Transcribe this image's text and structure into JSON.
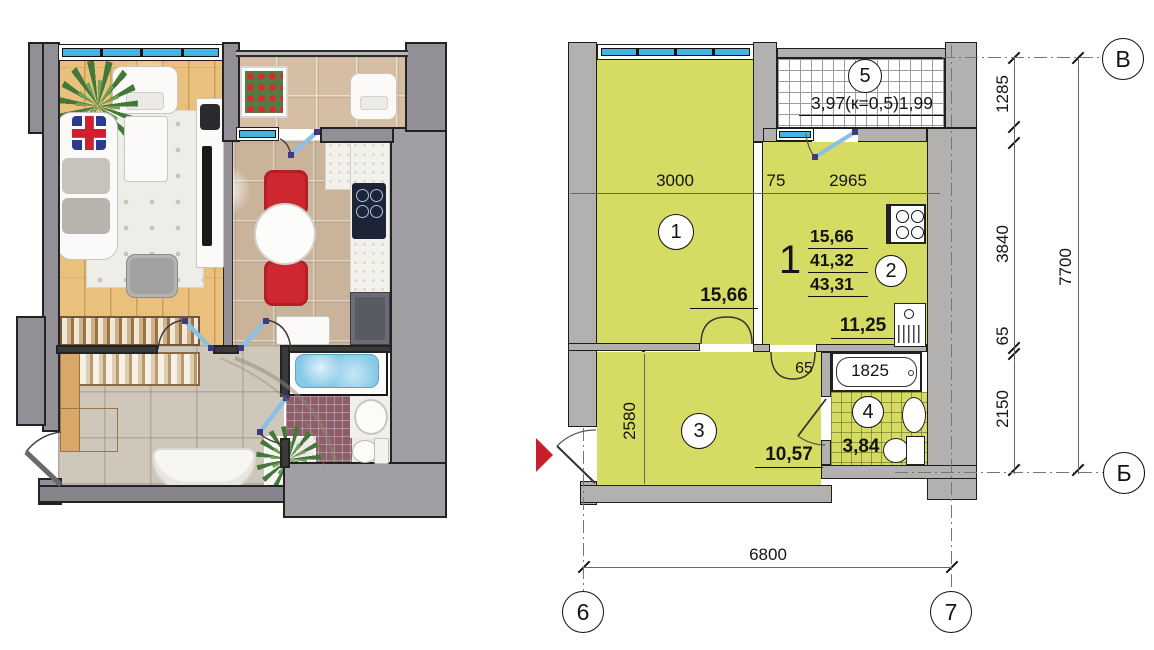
{
  "plan": {
    "rooms": {
      "living": {
        "number": "1",
        "area": "15,66"
      },
      "kitchen": {
        "number": "2",
        "area": "11,25"
      },
      "hall": {
        "number": "3",
        "area": "10,57"
      },
      "bath": {
        "number": "4",
        "area": "3,84"
      },
      "balcony": {
        "number": "5",
        "area": "3,97(к=0,5)1,99"
      }
    },
    "summary": {
      "room_count": "1",
      "living_area": "15,66",
      "apartment_area": "41,32",
      "total_area": "43,31"
    },
    "bathtub_length": "1825",
    "dimensions": {
      "top_room1": "3000",
      "top_wall": "75",
      "top_room2": "2965",
      "right_balcony": "1285",
      "right_kitchen": "3840",
      "right_wall": "65",
      "right_bath": "2150",
      "right_total": "7700",
      "bottom_total": "6800",
      "hall_width": "2580",
      "bath_wall": "65"
    },
    "axis_labels": {
      "top_right": "В",
      "bottom_right": "Б",
      "bottom_left_col": "6",
      "bottom_right_col": "7"
    }
  },
  "colors": {
    "room_fill": "#d6dc63",
    "wall_gray": "#b3b1b0",
    "window_blue": "#45b4e2",
    "door_blue": "#8ac0e4",
    "entry_arrow_red": "#c8202a",
    "water_blue": "#8fd0ea",
    "mosaic_purple": "#8d5e6a"
  }
}
